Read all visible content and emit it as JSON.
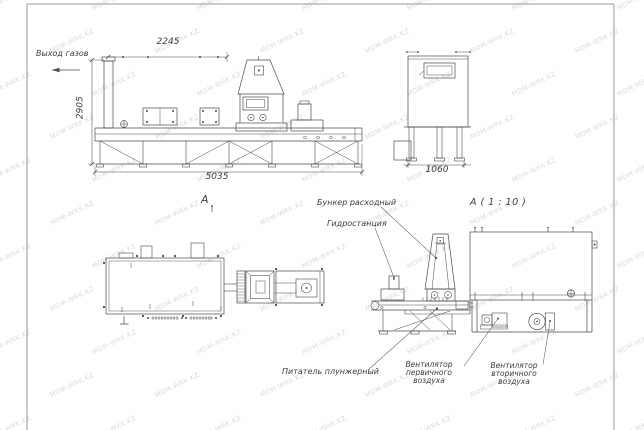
{
  "watermark": {
    "text": "MDM-WRK.KZ"
  },
  "views": {
    "side_view": {
      "gas_outlet_label": "Выход газов",
      "dim_width_top": "2245",
      "dim_height": "2905",
      "dim_width_total": "5035"
    },
    "end_view": {
      "dim_width": "1060"
    },
    "plan_view": {
      "view_arrow_label": "А"
    },
    "detail_view": {
      "title": "А ( 1 : 10 )",
      "callouts": {
        "hopper": "Бункер расходный",
        "hydraulic_station": "Гидростанция",
        "plunger_feeder": "Питатель плунжерный",
        "primary_air_fan": "Вентилятор\nпервичного воздуха",
        "secondary_air_fan": "Вентилятор\nвторичного воздуха"
      }
    }
  }
}
